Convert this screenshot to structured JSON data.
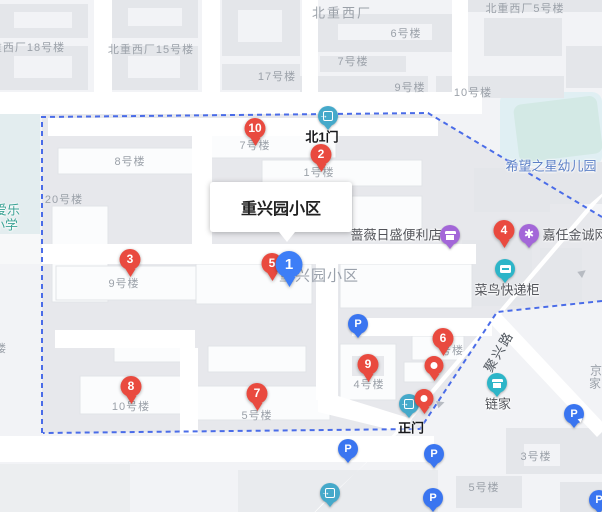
{
  "colors": {
    "marker_red": "#e94a3f",
    "marker_blue": "#3d7ef7",
    "parking_blue": "#3a75f0",
    "gate_teal": "#45a9ca",
    "poi_teal": "#2db5c8",
    "poi_purple": "#a367d8",
    "boundary_blue": "#4a6ce8",
    "building_label_gray": "#9ba1a9",
    "poi_label_dark": "#515359",
    "kindergarten_blue": "#5c80c6",
    "school_teal": "#3da496"
  },
  "tooltip": {
    "text": "重兴园小区",
    "x": 210,
    "y": 182,
    "w": 142,
    "h": 50
  },
  "map_label": {
    "text": "重兴园小区",
    "x": 319,
    "y": 275
  },
  "area_labels": [
    {
      "text": "北重西厂",
      "x": 342,
      "y": 12
    }
  ],
  "building_labels": [
    {
      "text": "北重西厂18号楼",
      "x": 22,
      "y": 47
    },
    {
      "text": "北重西厂15号楼",
      "x": 151,
      "y": 49
    },
    {
      "text": "17号楼",
      "x": 277,
      "y": 76
    },
    {
      "text": "6号楼",
      "x": 406,
      "y": 33
    },
    {
      "text": "7号楼",
      "x": 353,
      "y": 61
    },
    {
      "text": "9号楼",
      "x": 410,
      "y": 87
    },
    {
      "text": "10号楼",
      "x": 473,
      "y": 92
    },
    {
      "text": "北重西厂5号楼",
      "x": 525,
      "y": 8
    },
    {
      "text": "8号楼",
      "x": 130,
      "y": 161
    },
    {
      "text": "7号楼",
      "x": 255,
      "y": 145
    },
    {
      "text": "1号楼",
      "x": 319,
      "y": 172
    },
    {
      "text": "20号楼",
      "x": 64,
      "y": 199
    },
    {
      "text": "9号楼",
      "x": 124,
      "y": 283
    },
    {
      "text": "4号楼",
      "x": 369,
      "y": 384
    },
    {
      "text": "号楼",
      "x": 452,
      "y": 350
    },
    {
      "text": "10号楼",
      "x": 131,
      "y": 406
    },
    {
      "text": "5号楼",
      "x": 257,
      "y": 415
    },
    {
      "text": "3号楼",
      "x": 536,
      "y": 456
    },
    {
      "text": "5号楼",
      "x": 484,
      "y": 487
    },
    {
      "text": "楼",
      "x": 1,
      "y": 348
    }
  ],
  "poi_labels": [
    {
      "text": "蔷薇日盛便利店",
      "x": 396,
      "y": 234,
      "style": "dark"
    },
    {
      "text": "嘉任金诚网",
      "x": 575,
      "y": 234,
      "style": "dark"
    },
    {
      "text": "菜鸟快递柜",
      "x": 507,
      "y": 289,
      "style": "dark"
    },
    {
      "text": "链家",
      "x": 498,
      "y": 403,
      "style": "dark"
    },
    {
      "text": "希望之星幼儿园",
      "x": 551,
      "y": 165,
      "style": "blue"
    },
    {
      "text": "京",
      "x": 596,
      "y": 370,
      "style": "muted"
    },
    {
      "text": "家",
      "x": 595,
      "y": 383,
      "style": "muted"
    },
    {
      "text": "爱乐",
      "x": 7,
      "y": 209,
      "style": "teal"
    },
    {
      "text": "小学",
      "x": 5,
      "y": 224,
      "style": "teal"
    }
  ],
  "gate_labels": [
    {
      "text": "北1门",
      "x": 322,
      "y": 136
    },
    {
      "text": "正门",
      "x": 411,
      "y": 427
    }
  ],
  "road_label": {
    "text": "聚兴路",
    "x": 498,
    "y": 351,
    "rotation": -60
  },
  "markers_red": [
    {
      "num": "10",
      "x": 255,
      "y": 146
    },
    {
      "num": "2",
      "x": 321,
      "y": 172
    },
    {
      "num": "3",
      "x": 130,
      "y": 277
    },
    {
      "num": "5",
      "x": 272,
      "y": 281
    },
    {
      "num": "4",
      "x": 504,
      "y": 248
    },
    {
      "num": "6",
      "x": 443,
      "y": 356
    },
    {
      "num": "9",
      "x": 368,
      "y": 382
    },
    {
      "num": "7",
      "x": 257,
      "y": 411
    },
    {
      "num": "8",
      "x": 131,
      "y": 404
    }
  ],
  "marker_blue": {
    "num": "1",
    "x": 289,
    "y": 287
  },
  "markers_plain": [
    {
      "x": 434,
      "y": 381
    },
    {
      "x": 424,
      "y": 414
    }
  ],
  "gates": [
    {
      "x": 328,
      "y": 116
    },
    {
      "x": 409,
      "y": 404
    },
    {
      "x": 330,
      "y": 493
    }
  ],
  "parking": {
    "glyph": "P",
    "plain": [
      {
        "x": 358,
        "y": 324
      },
      {
        "x": 348,
        "y": 449
      },
      {
        "x": 434,
        "y": 454
      },
      {
        "x": 433,
        "y": 498
      },
      {
        "x": 599,
        "y": 500
      }
    ],
    "entrance": [
      {
        "x": 574,
        "y": 414
      }
    ]
  },
  "shops_purple": [
    {
      "x": 450,
      "y": 235,
      "kind": "store"
    },
    {
      "x": 529,
      "y": 234,
      "kind": "badge"
    }
  ],
  "shops_teal": [
    {
      "x": 505,
      "y": 269,
      "kind": "locker"
    },
    {
      "x": 497,
      "y": 383,
      "kind": "store"
    }
  ],
  "road_arrows": [
    {
      "x": 583,
      "y": 273,
      "rot": -38,
      "glyph": "▶"
    },
    {
      "x": 441,
      "y": 404,
      "rot": -18,
      "glyph": "▶"
    }
  ],
  "icons": {
    "arrow_right": "→",
    "asterisk": "✱",
    "play": "▶",
    "p": "P"
  }
}
